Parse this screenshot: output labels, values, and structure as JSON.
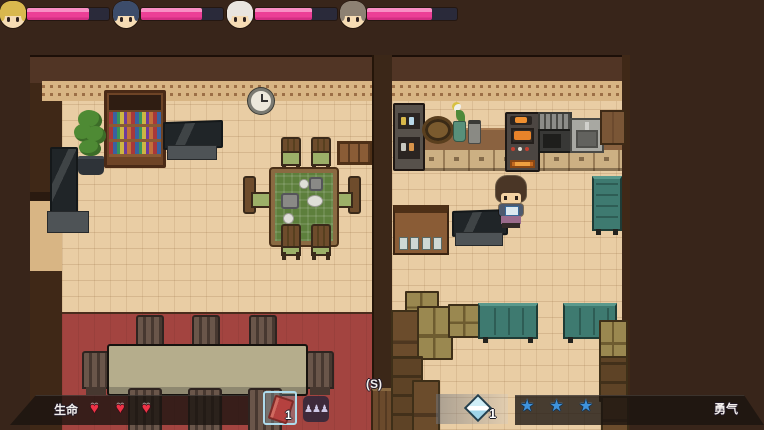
{
  "hud": {
    "party": [
      {
        "name": "party-member-1",
        "hair": "#d9b84e",
        "hp_percent": 76
      },
      {
        "name": "party-member-2",
        "hair": "#3c4c6a",
        "hp_percent": 74
      },
      {
        "name": "party-member-3",
        "hair": "#e9e5df",
        "hp_percent": 70
      },
      {
        "name": "party-member-4",
        "hair": "#8d8173",
        "hp_percent": 72
      }
    ],
    "life_label": "生命",
    "hearts_count": 3,
    "heart_glyph": "♥",
    "hotbar": [
      {
        "icon": "red-book",
        "count": "1",
        "selected": true
      },
      {
        "icon": "team-figures",
        "glyph": "♟♟♟",
        "selected": false
      }
    ],
    "key_hint": "(S)",
    "gem": {
      "icon": "diamond",
      "count": "1"
    },
    "stars_count": 3,
    "star_glyph": "★",
    "courage_label": "勇气",
    "colors": {
      "hp_fill": "#ec3f96",
      "hp_track": "#2a2a3a",
      "heart": "#ee3347",
      "star": "#3f93dc",
      "panel": "rgba(26,19,16,0.78)",
      "floor": "#e9cda4",
      "red_floor": "#a34440",
      "wall": "#513525",
      "background": "#38251a"
    }
  }
}
